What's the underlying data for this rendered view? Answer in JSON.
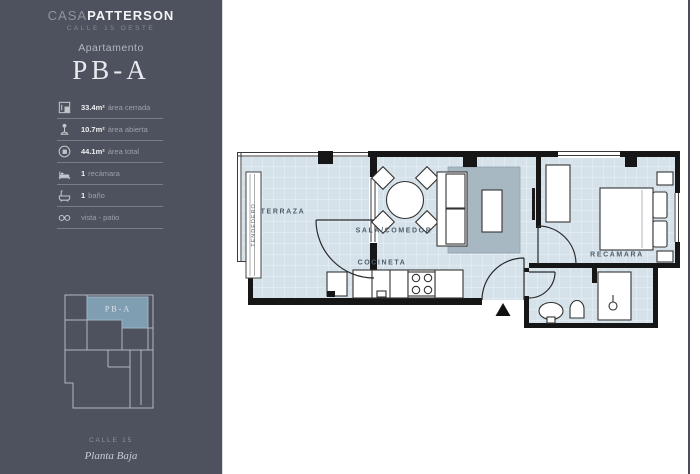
{
  "brand": {
    "name_light": "CASA",
    "name_bold": "PATTERSON",
    "subtitle": "CALLE 15 OESTE"
  },
  "apartment": {
    "label": "Apartamento",
    "name": "PB-A"
  },
  "specs": [
    {
      "icon": "closed-area-icon",
      "value": "33.4m²",
      "label": "área cerrada"
    },
    {
      "icon": "open-area-icon",
      "value": "10.7m²",
      "label": "área abierta"
    },
    {
      "icon": "total-area-icon",
      "value": "44.1m²",
      "label": "área total"
    },
    {
      "icon": "bed-icon",
      "value": "1",
      "label": "recámara"
    },
    {
      "icon": "bath-icon",
      "value": "1",
      "label": "baño"
    },
    {
      "icon": "view-icon",
      "value": "",
      "label": "vista - patio"
    }
  ],
  "minimap": {
    "unit_label": "PB-A",
    "street": "CALLE 15",
    "floor": "Planta Baja"
  },
  "floorplan": {
    "rooms": {
      "terraza": "TERRAZA",
      "sala": "SALA/COMEDOR",
      "cocineta": "COCINETA",
      "recamara": "RECÁMARA",
      "tendedero": "TENDEDERO"
    }
  },
  "colors": {
    "sidebar_bg": "#4e525e",
    "unit_accent": "#7f9eb2",
    "floor": "#d5e2ea",
    "rug": "#a7b8c2",
    "wall": "#161616",
    "plan_label": "#4e5e6a"
  }
}
